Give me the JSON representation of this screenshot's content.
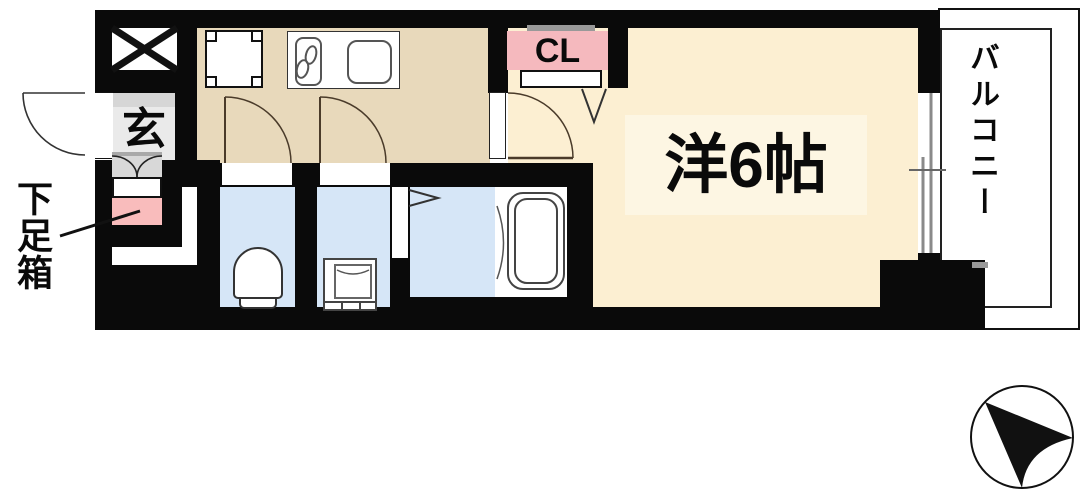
{
  "floor_plan": {
    "labels": {
      "entrance": "玄",
      "shoe_box": "下足箱",
      "closet": "CL",
      "main_room": "洋6帖",
      "balcony": "バルコニー"
    },
    "colors": {
      "wall": "#0a0a0a",
      "kitchen_hall_floor": "#e8d9bb",
      "main_room_floor": "#fcefd2",
      "room_label_bg": "#fdf6e3",
      "wet_room_floor": "#d6e6f7",
      "closet_fill": "#f5b9be",
      "shoe_box_fill": "#f9bcbc",
      "entrance_floor": "#eaeaea",
      "accent_gray": "#999999"
    },
    "symbols": {
      "elevator_shaft": "x-cross-box",
      "entrance_door": "quarter-arc-swing",
      "shoe_cupboard_doors": "double-quarter-arcs",
      "washing_machine_pan": "square-with-corner-pads",
      "stove": "two-burner-cooktop",
      "kitchen_sink": "rounded-square-basin",
      "interior_doors": "quarter-arc-swing",
      "closet_door": "folding-v",
      "bath_door": "folding-v",
      "toilet": "toilet-plan-symbol",
      "washbasin": "vanity-with-bowl",
      "bathtub": "double-outline-tub",
      "window": "sliding-window-double-line",
      "north_arrow": "compass-circle-arrow"
    }
  }
}
